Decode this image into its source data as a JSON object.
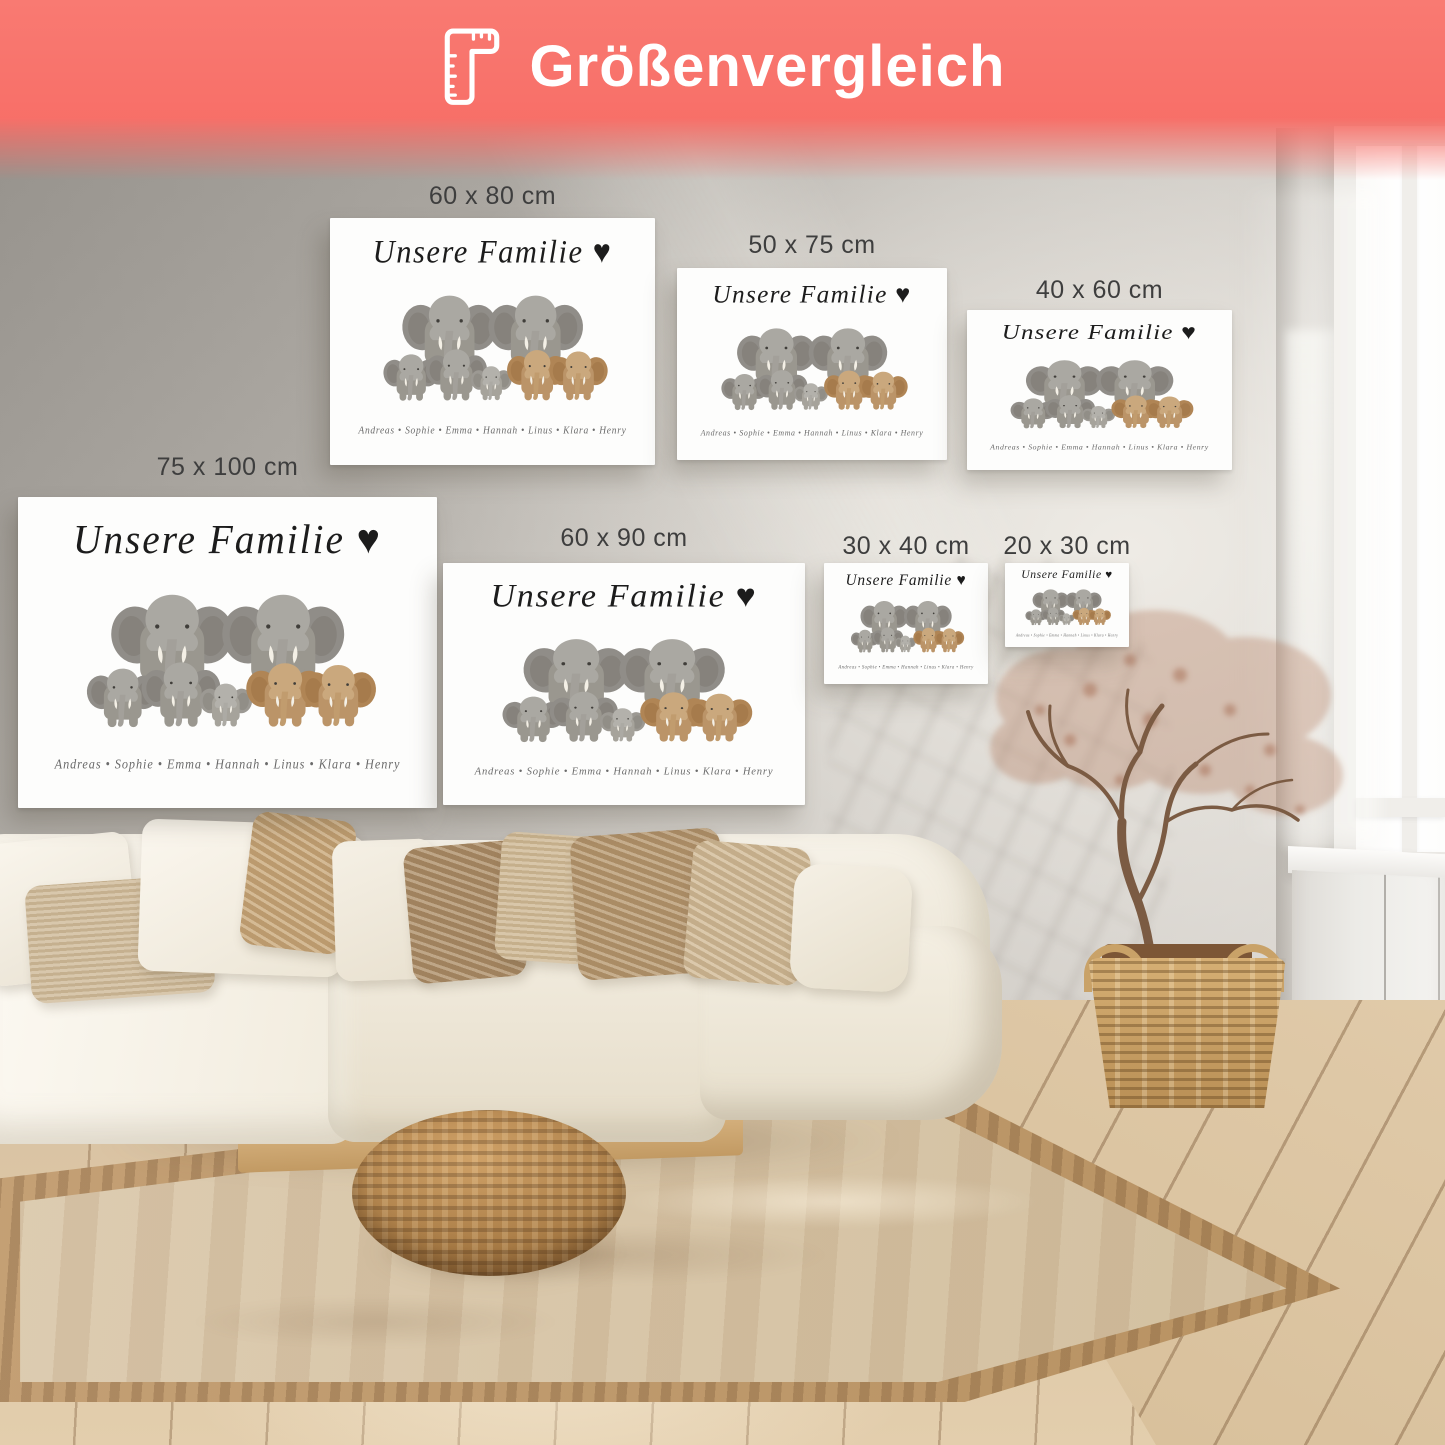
{
  "header": {
    "title": "Größenvergleich",
    "icon": "ruler-icon",
    "banner_color": "#f8716a",
    "text_color": "#ffffff"
  },
  "size_labels": [
    "60 x 80 cm",
    "50 x 75 cm",
    "40 x 60 cm",
    "75 x 100 cm",
    "60 x 90 cm",
    "30 x 40 cm",
    "20 x 30 cm"
  ],
  "label_color": "#3e3e3e",
  "poster_design": {
    "title": "Unsere Familie",
    "heart_symbol": "♥",
    "name_separator": "•",
    "family_names": [
      "Andreas",
      "Sophie",
      "Emma",
      "Hannah",
      "Linus",
      "Klara",
      "Henry"
    ],
    "background": "#fdfdfc",
    "title_color": "#1c1c1c",
    "names_color": "#6b6b6b",
    "elephant_colors": {
      "adult_grey": "#9a978f",
      "baby_grey": "#a6a39b",
      "tan_brown": "#bb9468",
      "tusk": "#f4f0e6"
    }
  },
  "room": {
    "wall_color": "#b9b5af",
    "floor_color": "#d9c3a4",
    "rug_color": "#d7c5a9",
    "rug_border_color": "#b89262",
    "sofa_color": "#f3eee3",
    "pouf_color": "#b98d5c",
    "basket_color": "#c9a268",
    "tree_foliage_color": "#a86a4b"
  }
}
